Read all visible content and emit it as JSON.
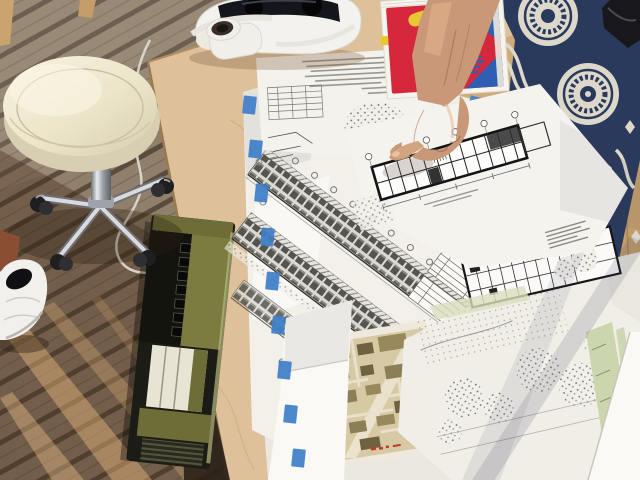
{
  "scene": {
    "description": "Outdoor wooden deck; a hand points at architectural floor-plan drawings spread on a plywood table; cream rolling stool, white VR headset, red book, green vintage radio, person in navy patterned dress",
    "objects": {
      "deck": "wooden deck boards",
      "table": "birch plywood table top",
      "stool": "cream round rolling stool with chrome casters",
      "vr_headset": "white VR headset",
      "webcam": "small white desk device",
      "book": "red book with yellow S and blue shapes on cover",
      "arm": "arm pointing with index finger at floor plan",
      "person_fabric": "navy and cream patterned dress",
      "radio": "olive-green vintage radio leaning on table edge",
      "shoe": "white sneaker",
      "cable": "white cable loop",
      "drawings": "overlapping architectural drawing sheets",
      "floor_plan": "bold-wall building floor plan",
      "elevations": "long building elevation strips with window grids",
      "site_plan": "landscape site plan with stippled trees",
      "city_map": "colored city block map",
      "tape": "blue painter's tape pieces"
    }
  },
  "colors": {
    "deck_board": "#8f7f6b",
    "deck_gap": "#5a4c3d",
    "table_wood": "#dec19b",
    "paper": "#f2f0e9",
    "paper_bright": "#faf9f5",
    "paper_dim": "#e9e7e0",
    "tape_blue": "#3f7fca",
    "book_red": "#d5283c",
    "book_yellow": "#e8c832",
    "book_blue": "#2f5fb0",
    "skin": "#c89878",
    "fabric_navy": "#2a3a5c",
    "fabric_cream": "#ddd8ca",
    "seat_cream": "#efe9d2",
    "chrome": "#c8ccd2",
    "caster_black": "#1f1f22",
    "radio_olive": "#7c7c40",
    "radio_black": "#1c1c16",
    "radio_keys": "#e8e4d4",
    "map_tan": "#d6c9a4",
    "map_block": "#8c7f55",
    "green_strip": "#ccd6ae",
    "shoe_white": "#f2f0ec",
    "headset_white": "#f4f2ee",
    "headset_dark": "#14161c",
    "wood_chair": "#c9a571",
    "deck_red": "#7e4a36",
    "dark_object": "#17171c",
    "cable": "#dcd8ce",
    "ink": "#1a1a18"
  }
}
